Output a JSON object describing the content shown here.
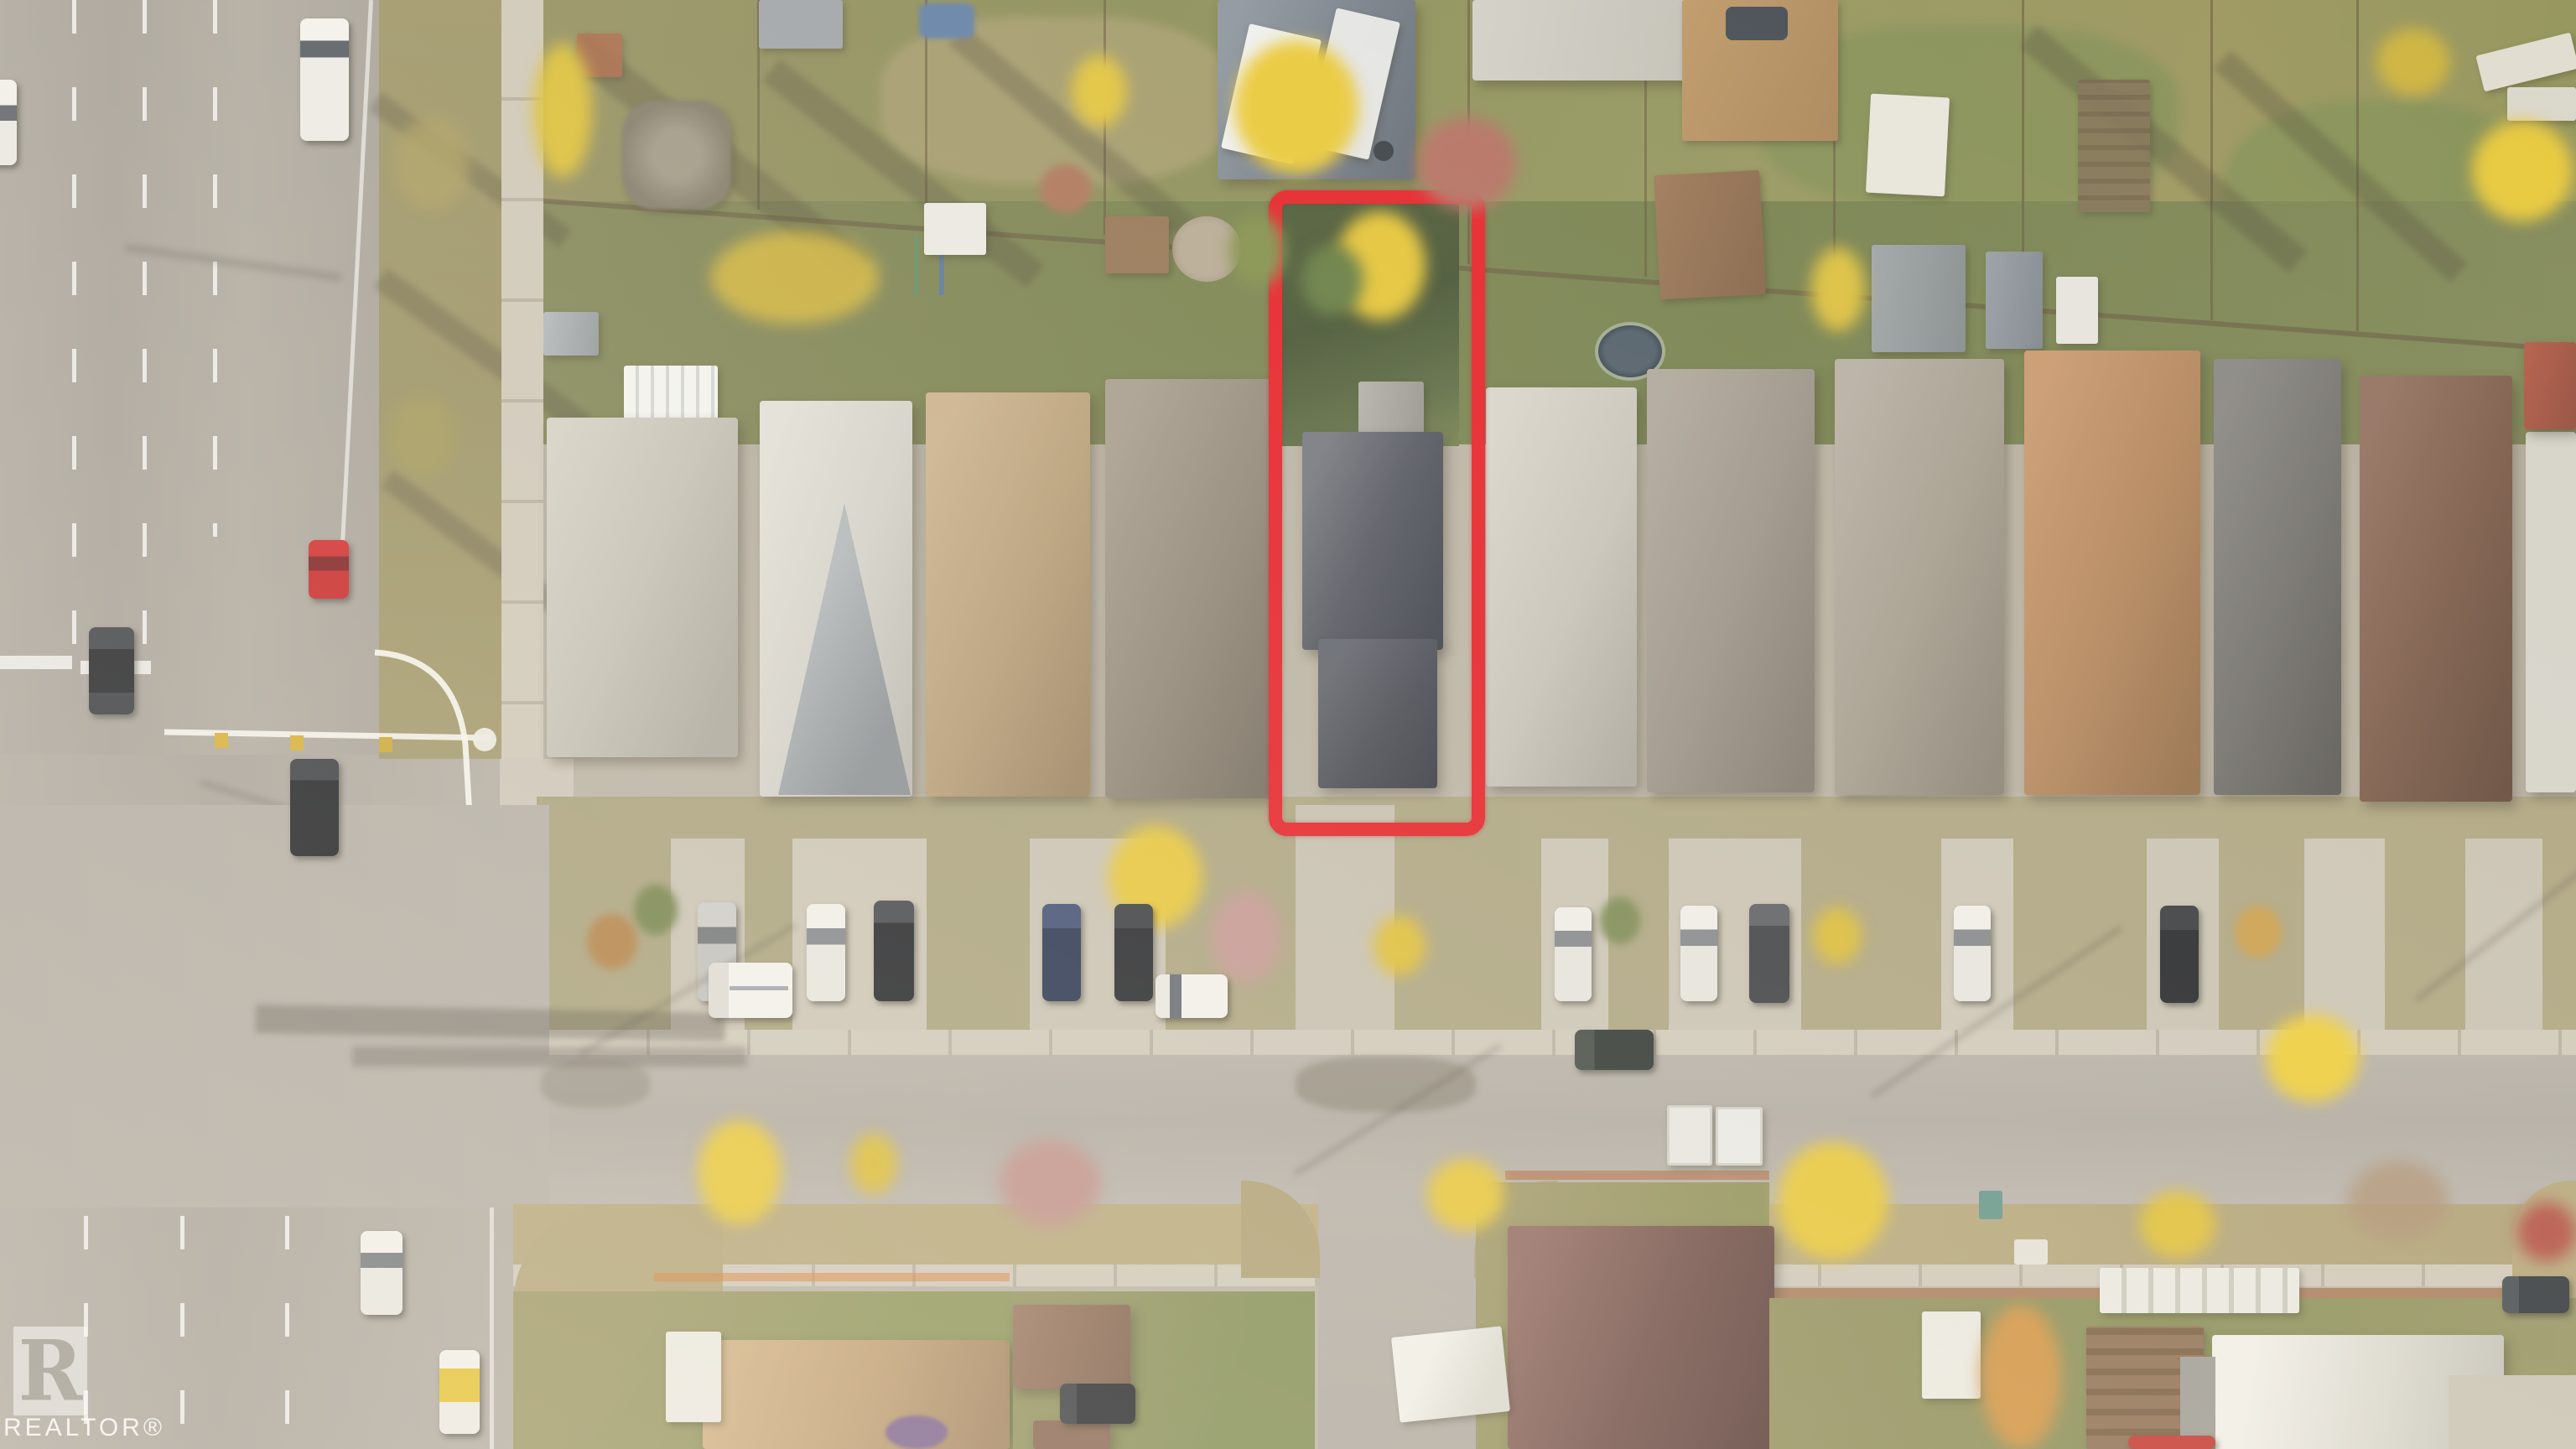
{
  "image": {
    "kind": "aerial-drone-photo",
    "description": "Overhead autumn aerial photo of a suburban residential block; a deep narrow lot with a dark charcoal-roofed house is outlined in red for a real-estate listing.",
    "season": "autumn"
  },
  "watermark": {
    "logo_letter": "R",
    "label": "REALTOR®"
  },
  "highlight": {
    "purpose": "property-lot-boundary",
    "color": "#e3161d",
    "shape": "tall rounded rectangle over full lot: backyard, house, driveway"
  },
  "scene": {
    "roads": {
      "left_arterial": "wide multi-lane road running vertically on the left with white dashed lane lines, stop bars, crosswalk and a signalized intersection",
      "main_street": "residential street running horizontally across the middle with parked cars along the house fronts",
      "side_street": "small street branching south from the main street between the lower houses"
    },
    "subject_row_roofs": [
      "warm gray hip",
      "pale gray gable",
      "tan hip",
      "gray-brown hip",
      "dark charcoal (subject)",
      "light gray hip",
      "gray-brown gable",
      "taupe gable",
      "orange-brown gable",
      "dark gray gable",
      "red-brown gable"
    ],
    "vehicles": [
      {
        "color": "white",
        "type": "van",
        "location": "driving north on arterial, top left"
      },
      {
        "color": "white",
        "type": "pickup",
        "location": "left edge, partially out of frame"
      },
      {
        "color": "red",
        "type": "car",
        "location": "arterial right lane above intersection"
      },
      {
        "color": "black",
        "type": "car",
        "location": "arterial at stop bar"
      },
      {
        "color": "black",
        "type": "suv",
        "location": "inside intersection"
      },
      {
        "color": "white",
        "type": "sedan",
        "location": "arterial below intersection"
      },
      {
        "color": "white-yellow stripe",
        "type": "taxi",
        "location": "arterial bottom left"
      },
      {
        "color": "white",
        "type": "utility cube truck",
        "location": "main street near intersection"
      },
      {
        "color": "white",
        "type": "sedan",
        "location": "driving on main street center"
      },
      {
        "color": "silver / white / black / blue",
        "type": "parked cars",
        "location": "front parking pads of the house row"
      },
      {
        "color": "dark green-gray",
        "type": "suv",
        "location": "parked on main street right side"
      },
      {
        "color": "white",
        "type": "rv-trailer",
        "location": "front of maroon-roof house bottom center"
      }
    ],
    "landscape": [
      "bright yellow autumn trees",
      "pink bare ornamental trees",
      "dark green subject backyard",
      "dry tan boulevards",
      "long pole and tree shadows"
    ]
  }
}
